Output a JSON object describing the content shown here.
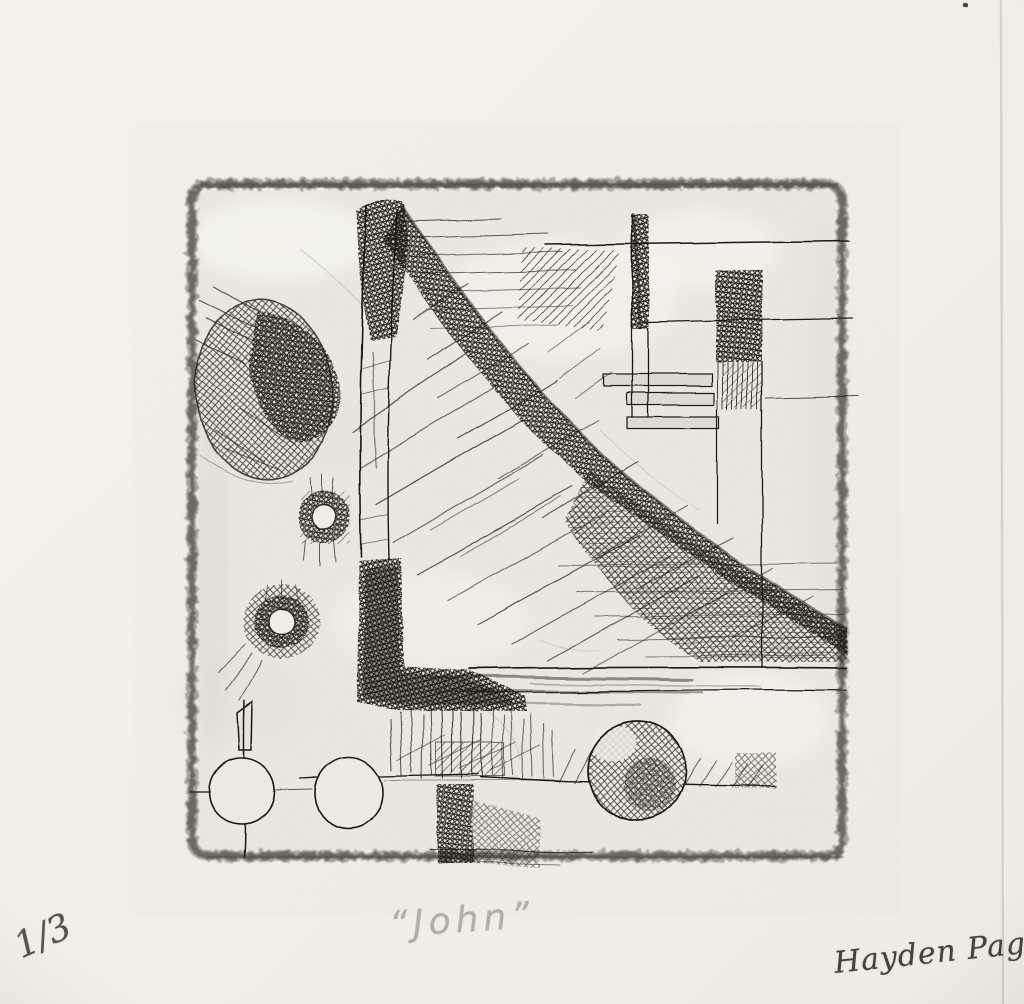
{
  "artwork": {
    "title": "“John”",
    "edition": "1/3",
    "signature": "Hayden Page"
  },
  "colors": {
    "paper": "#f1efe9",
    "plate_tone": "#ebe8e1",
    "plate_edge": "#615e55",
    "ink": "#1b1915",
    "pencil_title": "#b2ada5",
    "pencil_edition": "#57524b",
    "pencil_signature": "#46413b"
  }
}
